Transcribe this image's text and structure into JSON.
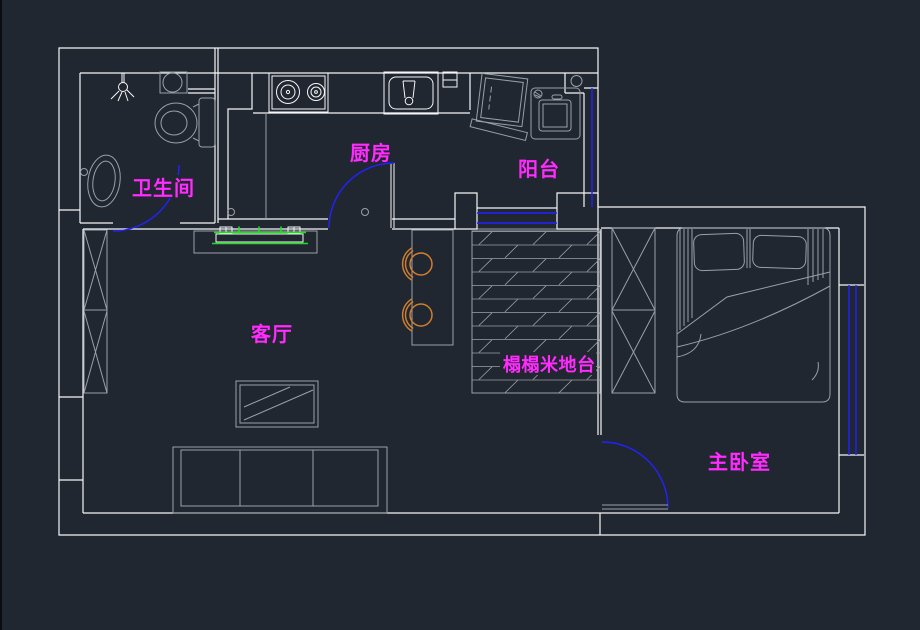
{
  "drawing": {
    "kind": "apartment floor plan (CAD)",
    "rooms": {
      "bathroom": "卫生间",
      "kitchen": "厨房",
      "balcony": "阳台",
      "living_room": "客厅",
      "tatami": "榻榻米地台",
      "master_bedroom": "主卧室"
    }
  },
  "colors": {
    "bg": "#212730",
    "edge": "#0a0c0e",
    "wall": "#f5f6f7",
    "fur": "#9aa0a6",
    "blue": "#2222ff",
    "magenta": "#ff2bff",
    "orange": "#cf7e2e",
    "green": "#19e619"
  }
}
